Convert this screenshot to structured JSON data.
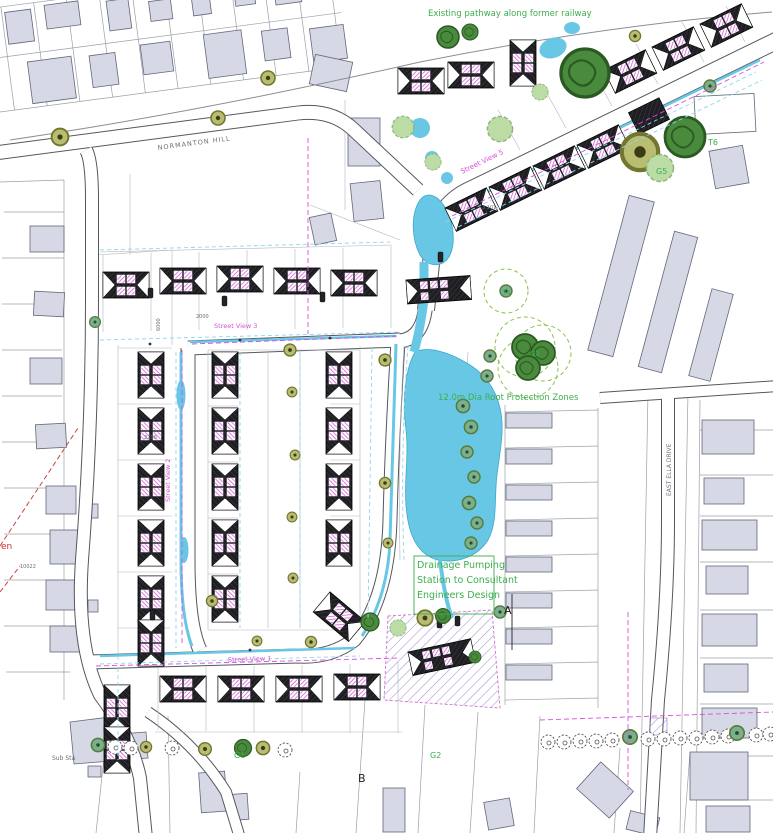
{
  "plan": {
    "annotations": {
      "existing_pathway": "Existing pathway along former railway",
      "root_protection": "12.0m Dia Root Protection Zones",
      "pumping_1": "Drainage Pumping",
      "pumping_2": "Station to Consultant",
      "pumping_3": "Engineers Design"
    },
    "roads": {
      "normanton_hill": "NORMANTON HILL",
      "east_ella_drive": "EAST ELLA DRIVE"
    },
    "street_views": {
      "sv1": "Street View 1",
      "sv2": "Street View 2",
      "sv3": "Street View 3",
      "sv5": "Street View 5"
    },
    "markers": {
      "t6": "T6",
      "g5": "G5",
      "g3": "G3",
      "t4": "T4",
      "g1": "G1",
      "g2": "G2",
      "section_a": "A",
      "section_b": "B"
    },
    "misc": {
      "sub_station": "Sub Sta",
      "edge_fragment": "en"
    },
    "dimensions": {
      "d2700": "2700",
      "d6000": "6000",
      "d2000": "2000",
      "d3101": "3.101",
      "d10022": "10022"
    },
    "colors": {
      "water": "#69c7e6",
      "existing_building": "#d6d8e5",
      "new_house": "#1b1b1f",
      "magenta": "#d84fd8",
      "annotation_green": "#3cae4e",
      "tree_green": "#4a8a3c",
      "tree_olive": "#b9bd72",
      "purple_hatch": "#8a6cc0",
      "red_dashed": "#cc4444"
    }
  }
}
